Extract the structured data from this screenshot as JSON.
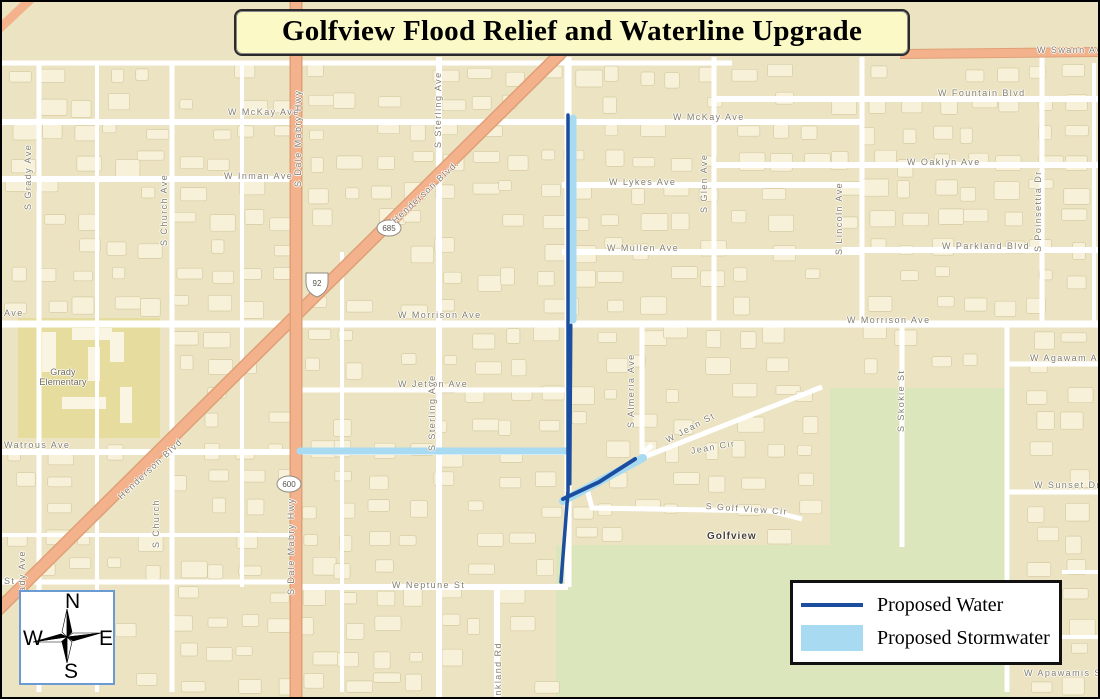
{
  "title": "Golfview Flood Relief and Waterline Upgrade",
  "legend": {
    "water_label": "Proposed Water",
    "stormwater_label": "Proposed Stormwater"
  },
  "compass": {
    "north": "N",
    "east": "E",
    "south": "S",
    "west": "W"
  },
  "route_shields": {
    "us92": "92",
    "fl685": "685",
    "fl600": "600"
  },
  "colors": {
    "proposed_water": "#1b4e9e",
    "proposed_stormwater": "#a8dbf2",
    "highway_orange": "#f3b28c",
    "highway_edge": "#dfa077",
    "golf_green": "#dbe6bc",
    "school_block": "#e6dc9e",
    "map_tan": "#ece3c2",
    "title_bg": "#fbf9c6"
  },
  "map_labels": {
    "swann": "W Swann Av",
    "fountain": "W Fountain Blvd",
    "mckay_left": "W McKay Ave",
    "mckay_right": "W McKay Ave",
    "inman": "W Inman Ave",
    "oaklyn": "W Oaklyn Ave",
    "lykes": "W Lykes Ave",
    "mullen": "W Mullen Ave",
    "parkland": "W Parkland Blvd",
    "morrison_left_fragment": "Ave",
    "morrison_center": "W Morrison Ave",
    "morrison_right": "W Morrison Ave",
    "agawam": "W Agawam Ave",
    "jetton": "W Jetton Ave",
    "watrous": "Watrous Ave",
    "jean_st": "W Jean St",
    "jean_cir": "Jean Cir",
    "sunset": "W Sunset Dr",
    "golf_view_cir": "S Golf View Cir",
    "golfview": "Golfview",
    "neptune": "W Neptune St",
    "apawamis": "W Apawamis St",
    "st_fragment": "St",
    "grady_ave": "S Grady Ave",
    "grady_ave_lower": "ady Ave",
    "church_ave": "S Church Ave",
    "church_lower": "S Church",
    "dale_mabry_upper": "S Dale Mabry Hwy",
    "dale_mabry_lower": "S Dale Mabry Hwy",
    "sterling_upper": "S Sterling Ave",
    "sterling_lower": "S Sterling Ave",
    "henderson_upper": "Henderson Blvd.",
    "henderson_lower": "Henderson Blvd",
    "glen": "S Glen Ave",
    "lincoln": "S Lincoln Ave",
    "poinsettia": "S Poinsettia Dr",
    "skokie": "S Skokie St",
    "almeria": "S Almeria Ave",
    "frankland": "ankland Rd",
    "grady_elementary": "Grady Elementary"
  }
}
